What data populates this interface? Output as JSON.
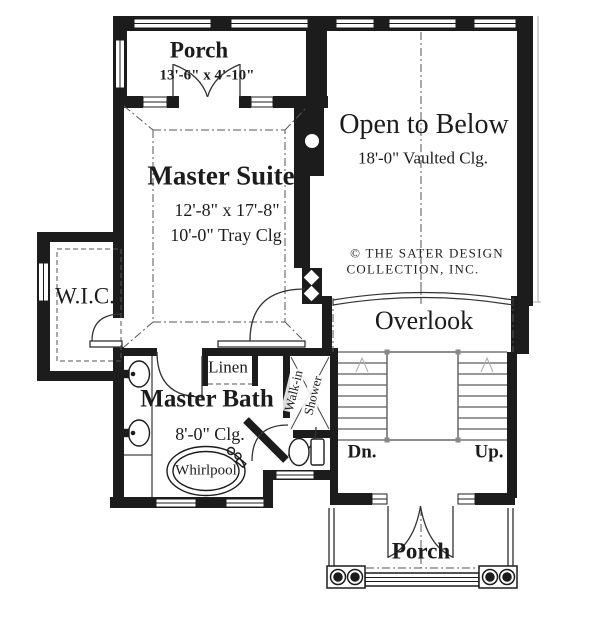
{
  "labels": {
    "porch_top": "Porch",
    "porch_top_dims": "13'-6\" x 4'-10\"",
    "master_suite": "Master Suite",
    "master_suite_dims": "12'-8\" x 17'-8\"",
    "master_suite_clg": "10'-0\" Tray Clg",
    "open_to_below": "Open to Below",
    "open_to_below_clg": "18'-0\" Vaulted Clg.",
    "copyright_1": "© THE SATER DESIGN",
    "copyright_2": "COLLECTION, INC.",
    "wic": "W.I.C.",
    "overlook": "Overlook",
    "linen": "Linen",
    "master_bath": "Master Bath",
    "master_bath_clg": "8'-0\" Clg.",
    "shower_1": "Walk-in",
    "shower_2": "Shower",
    "whirlpool": "Whirlpool",
    "stairs_dn": "Dn.",
    "stairs_up": "Up.",
    "porch_bottom": "Porch"
  },
  "colors": {
    "wall": "#1c1c1c",
    "line": "#333333",
    "dash": "#555555",
    "background": "#ffffff"
  }
}
